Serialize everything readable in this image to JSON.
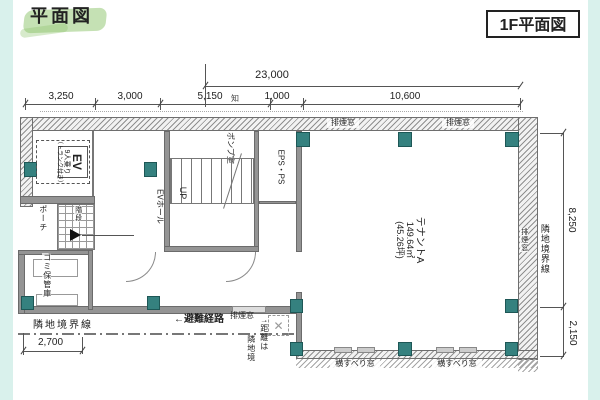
{
  "header": {
    "title": "平面図",
    "plan_box_label": "1F平面図"
  },
  "dims": {
    "total_width": "23,000",
    "segments": [
      "3,250",
      "3,000",
      "5,150",
      "1,000",
      "10,600"
    ],
    "axis_note": "知",
    "right_upper": "8,250",
    "right_lower": "2,150",
    "left_bottom": "2,700"
  },
  "rooms": {
    "elevator": {
      "name": "EV",
      "capacity": "9人乗り",
      "trunk": "（トランク付き）"
    },
    "ev_hall": "EVホール",
    "pump_room": "ポンプ室",
    "stairs_up": "UP",
    "eps_ps": "EPS・PS",
    "porch": "ポーチ",
    "steps": "階段",
    "garbage": "ゴミ保管庫",
    "tenant": {
      "name": "テナントA",
      "area_m2": "149.64㎡",
      "area_tsubo": "(45.26坪)"
    }
  },
  "annotations": {
    "boundary_left": "隣地境界線",
    "boundary_right": "隣地境界線",
    "evac_route": "←避難経路",
    "note_col1": "↑距離は",
    "note_col2": "隣地境",
    "top_windows": [
      "排煙窓",
      "排煙窓"
    ],
    "bottom_window_label": "排煙窓",
    "right_window": "排煙窓",
    "sliding_windows": [
      "横すべり窓",
      "横すべり窓"
    ]
  },
  "colors": {
    "column_teal": "#35817f",
    "bg_mint": "#d9f1ec",
    "highlight_green": "#8cc46a"
  }
}
